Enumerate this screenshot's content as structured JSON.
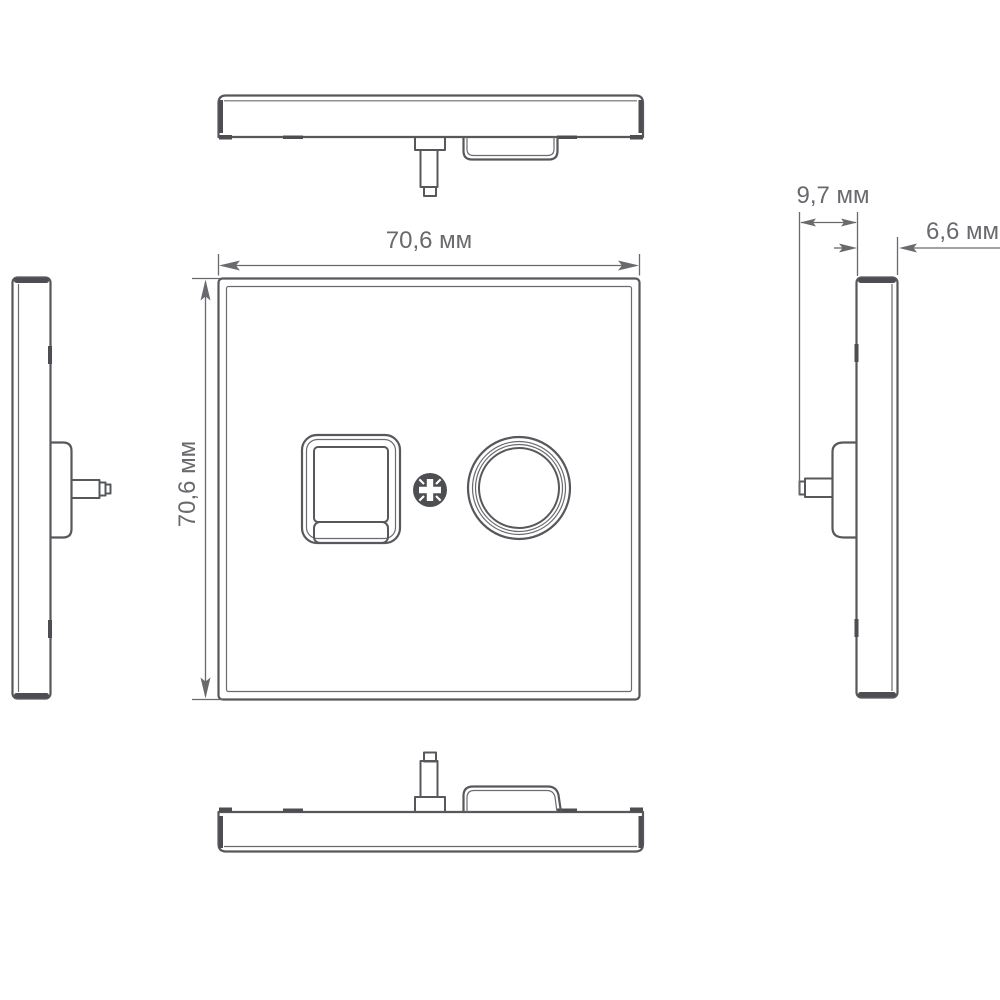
{
  "drawing": {
    "dimension_labels": {
      "width": "70,6 мм",
      "height": "70,6 мм",
      "depth": "9,7 мм",
      "thickness": "6,6 мм"
    },
    "unit": "мм",
    "colors": {
      "background": "#ffffff",
      "outline": "#57585c",
      "heavy_edge": "#4d4e52",
      "dimension": "#696a6e"
    }
  }
}
